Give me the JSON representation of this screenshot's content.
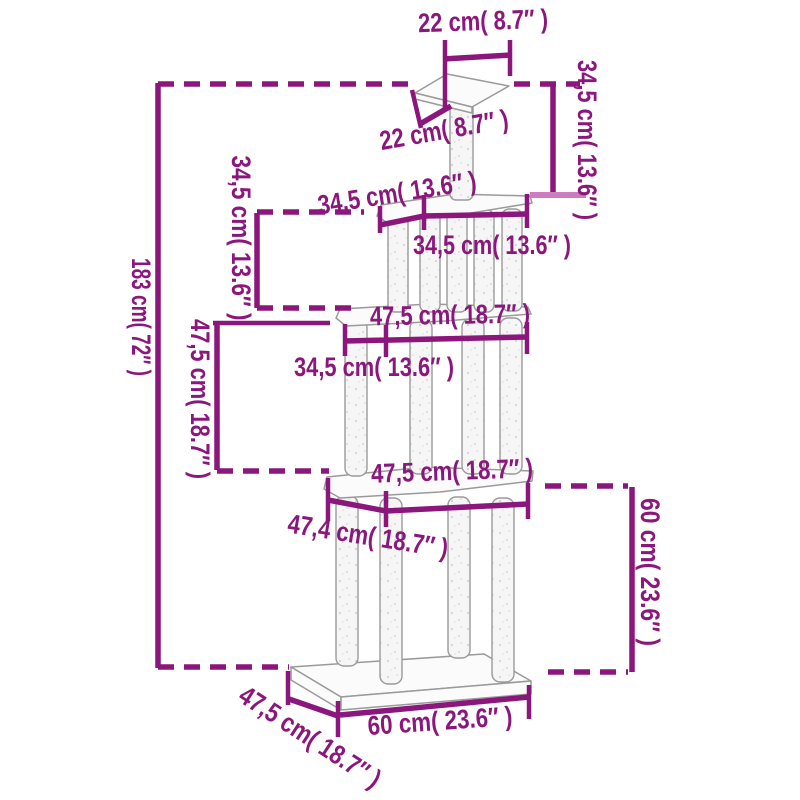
{
  "figure": {
    "kind": "product-dimension-diagram",
    "subject": "cat-tree-with-scratching-posts",
    "accent_color": "#8b177c",
    "light_tick_color": "#cb7dc0",
    "outline_color": "#9a9a9a",
    "labels": {
      "top_width": "22 cm( 8.7″ )",
      "top_depth": "22 cm( 8.7″ )",
      "top_post_height": "34,5 cm( 13.6″ )",
      "tier2_depth": "34,5 cm( 13.6″ )",
      "tier2_width": "34,5 cm( 13.6″ )",
      "tier2_height": "34,5 cm( 13.6″ )",
      "tier3_width": "47,5 cm( 18.7″ )",
      "tier3_post_spacing": "34,5 cm( 13.6″ )",
      "tier3_height": "47,5 cm( 18.7″ )",
      "total_height": "183 cm( 72″ )",
      "tier4_width": "47,5 cm( 18.7″ )",
      "tier4_depth": "47,4 cm( 18.7″ )",
      "base_section_height": "60 cm( 23.6″ )",
      "base_width": "60 cm( 23.6″ )",
      "base_depth": "47,5 cm( 18.7″ )"
    }
  }
}
